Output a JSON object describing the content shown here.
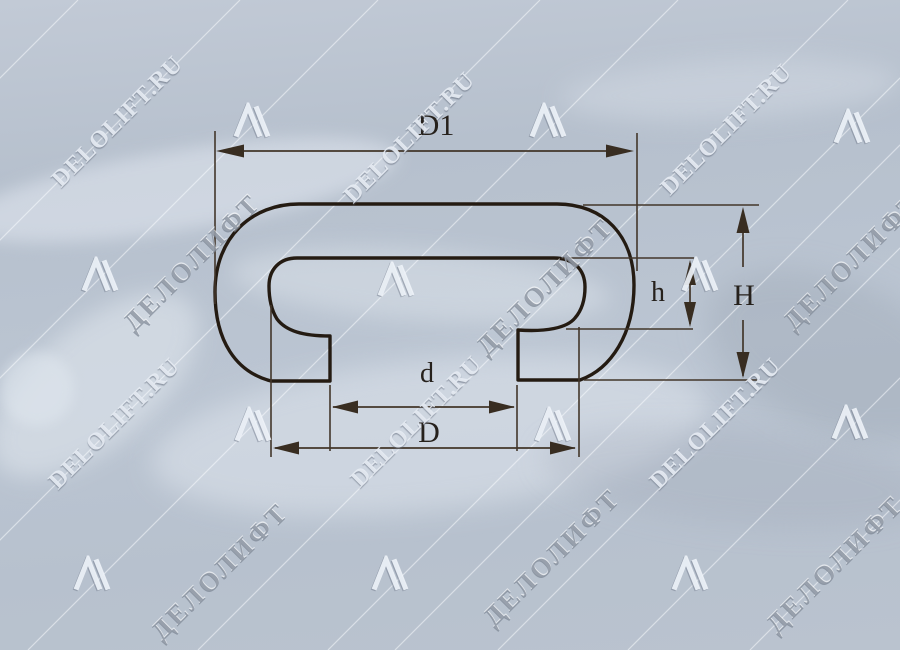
{
  "figure": {
    "type": "technical-drawing",
    "subject": "Handrail profile cross-section with dimension callouts",
    "labels": {
      "outer_width_top": "D1",
      "inner_height": "h",
      "total_height": "H",
      "mouth_width": "d",
      "base_width": "D"
    },
    "colors": {
      "background": "#b7c1ce",
      "profile_line": "#241b12",
      "dimension_line": "#42362a",
      "label_text": "#26211c"
    }
  },
  "watermark": {
    "latin": "DELOLIFT.RU",
    "cyrillic": "ДЕЛОЛИФТ",
    "logo": "delolift-triangle-logo"
  }
}
